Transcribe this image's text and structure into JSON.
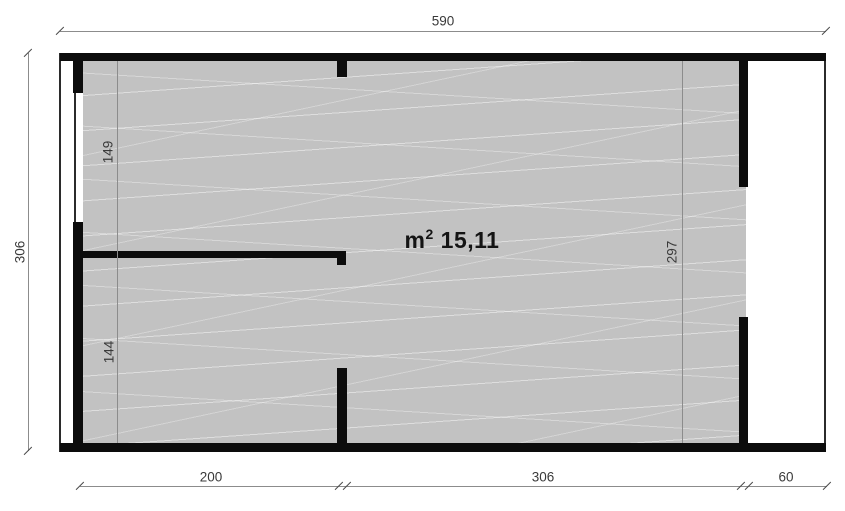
{
  "colors": {
    "wall": "#0c0c0c",
    "floor": "#c2c2c2",
    "dim_line": "#8c8c8c",
    "thin_line": "#2b2b2b",
    "text": "#3a3a3a"
  },
  "plan": {
    "area": {
      "unit": "m",
      "sup": "2",
      "value": "15,11"
    },
    "dims": {
      "top": "590",
      "left": "306",
      "inner_left_upper": "149",
      "inner_left_lower": "144",
      "inner_right": "297",
      "bottom_left": "200",
      "bottom_middle": "306",
      "bottom_right": "60"
    }
  }
}
